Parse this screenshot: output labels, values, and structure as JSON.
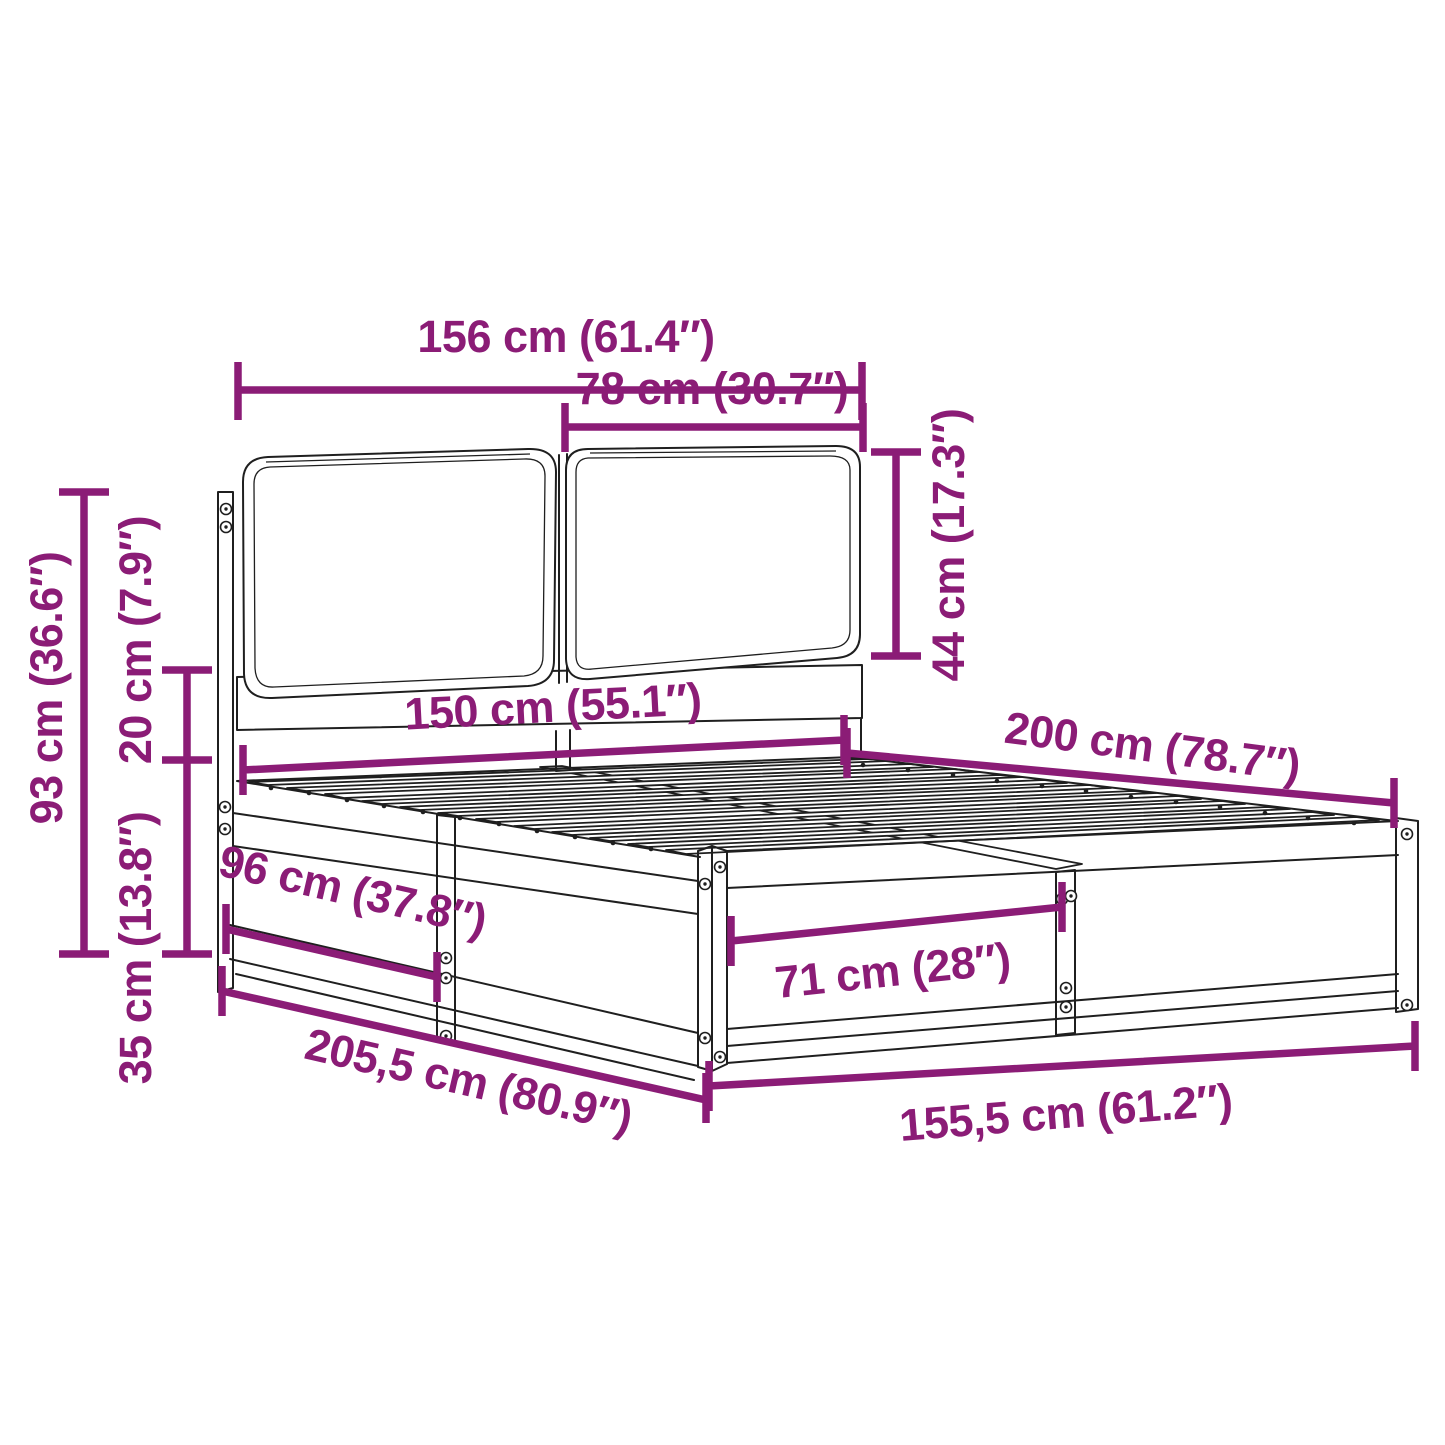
{
  "diagram": {
    "subject": "bed frame with cushioned headboard and slatted base — dimension diagram",
    "colors": {
      "dimension": "#8b1c76",
      "line_art": "#1f1f1f",
      "background": "#ffffff"
    },
    "measurements": {
      "headboard_width": {
        "label": "156 cm (61.4″)"
      },
      "cushion_width": {
        "label": "78 cm (30.7″)"
      },
      "cushion_height": {
        "label": "44 cm (17.3″)"
      },
      "headboard_height": {
        "label": "93 cm (36.6″)"
      },
      "headboard_gap": {
        "label": "20 cm (7.9″)"
      },
      "base_height": {
        "label": "35 cm (13.8″)"
      },
      "side_section": {
        "label": "96 cm (37.8″)"
      },
      "slat_area_width": {
        "label": "150 cm (55.1″)"
      },
      "slat_area_length": {
        "label": "200 cm (78.7″)"
      },
      "foot_section": {
        "label": "71 cm (28″)"
      },
      "overall_length": {
        "label": "205,5 cm (80.9″)"
      },
      "overall_width": {
        "label": "155,5 cm (61.2″)"
      }
    }
  }
}
